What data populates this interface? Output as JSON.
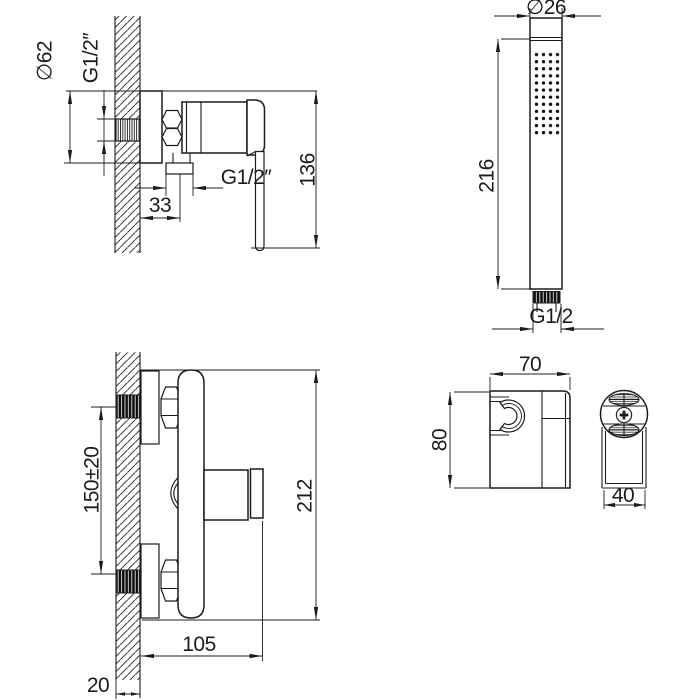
{
  "drawing_type": "shower-mixer-installation-dimensions",
  "colors": {
    "line": "#1c1c1c",
    "background": "#ffffff"
  },
  "labels": {
    "side_flange_dia": "∅62",
    "side_wall_thread": "G1/2″",
    "side_offset": "33",
    "side_outlet_thread": "G1/2″",
    "side_height": "136",
    "shower_dia": "∅26",
    "shower_length": "216",
    "shower_thread": "G1/2",
    "front_inlet_spacing": "150±20",
    "front_height": "212",
    "front_width": "105",
    "front_wall_thickness": "20",
    "bracket_width": "70",
    "bracket_height": "80",
    "bracket_depth": "40"
  }
}
